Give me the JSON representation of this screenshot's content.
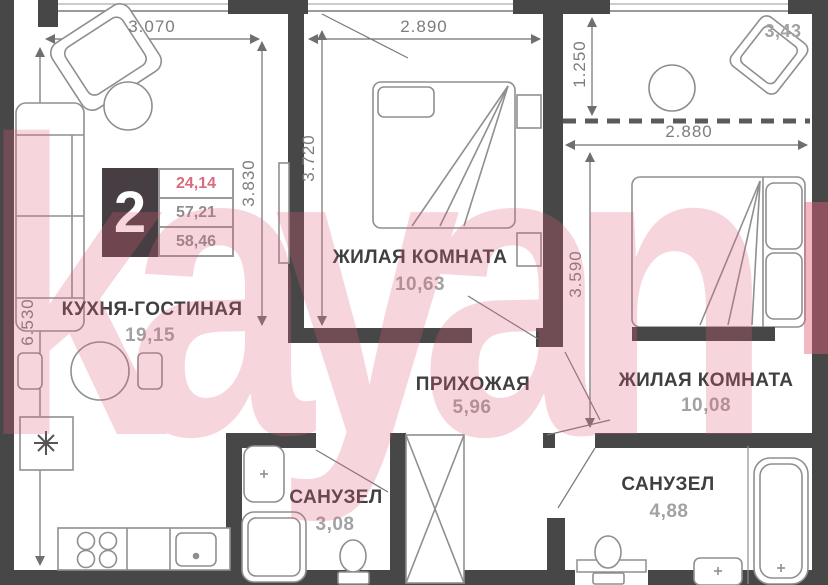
{
  "plan": {
    "badge": {
      "number": "2",
      "area_living": "24,14",
      "area_usable": "57,21",
      "area_total": "58,46"
    },
    "rooms": {
      "kitchen_living": {
        "name": "КУХНЯ-ГОСТИНАЯ",
        "area": "19,15"
      },
      "bedroom_1": {
        "name": "ЖИЛАЯ КОМНАТА",
        "area": "10,63"
      },
      "hallway": {
        "name": "ПРИХОЖАЯ",
        "area": "5,96"
      },
      "bedroom_2": {
        "name": "ЖИЛАЯ КОМНАТА",
        "area": "10,08"
      },
      "bathroom_1": {
        "name": "САНУЗЕЛ",
        "area": "3,08"
      },
      "bathroom_2": {
        "name": "САНУЗЕЛ",
        "area": "4,88"
      },
      "loggia": {
        "area": "3,43"
      }
    },
    "dimensions": {
      "kitchen_width": "3.070",
      "bedroom1_width": "2.890",
      "loggia_depth": "1.250",
      "bedroom2_width": "2.880",
      "kitchen_height": "3.830",
      "bedroom1_height": "3.720",
      "bedroom2_height": "3.590",
      "left_total_height": "6.530"
    },
    "watermark": {
      "text": "kayan",
      "color": "#e4607a"
    },
    "colors": {
      "wall": "#474747",
      "furniture_line": "#8f8f8f",
      "dimension_line": "#6f6f6f",
      "label": "#3f3f3f",
      "area_text": "#a2a2a2",
      "badge_bg": "#463e42",
      "highlight": "#d96b7c"
    }
  }
}
